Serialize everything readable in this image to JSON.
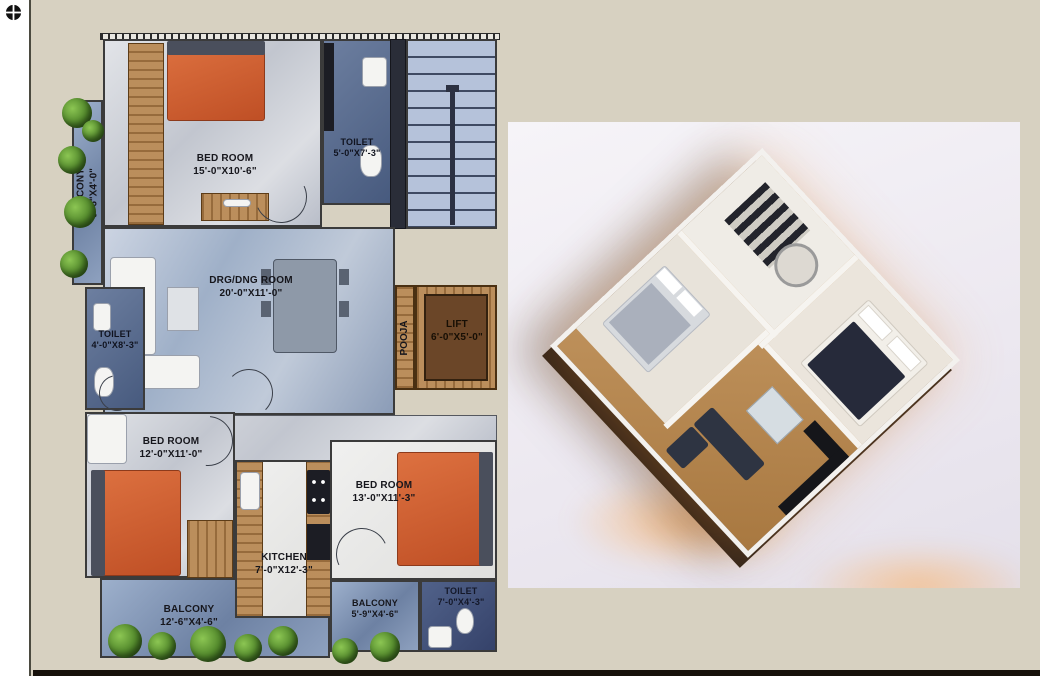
{
  "colors": {
    "page_bg": "#d7d1c1",
    "sidebar_bg": "#ffffff",
    "divider": "#4b4a40",
    "bottom_bar": "#17110b",
    "plan_text": "#16161c",
    "bed_orange": "#cd5f33",
    "floor_blue": "#7f93b4",
    "floor_grey": "#c9ccd3",
    "wood": "#b5854e",
    "photo_bg": "#efecf3"
  },
  "sidebar": {
    "icon": "crosshair-target-icon"
  },
  "plan2d": {
    "rooms": [
      {
        "label": "BED ROOM",
        "dims": "15'-0\"X10'-6\""
      },
      {
        "label": "TOILET",
        "dims": "5'-0\"X7'-3\""
      },
      {
        "label": "BALCONY",
        "dims": "9'-6\"X4'-0\""
      },
      {
        "label": "DRG/DNG ROOM",
        "dims": "20'-0\"X11'-0\""
      },
      {
        "label": "POOJA",
        "dims": ""
      },
      {
        "label": "LIFT",
        "dims": "6'-0\"X5'-0\""
      },
      {
        "label": "TOILET",
        "dims": "4'-0\"X8'-3\""
      },
      {
        "label": "BED ROOM",
        "dims": "12'-0\"X11'-0\""
      },
      {
        "label": "BED ROOM",
        "dims": "13'-0\"X11'-3\""
      },
      {
        "label": "KITCHEN",
        "dims": "7'-0\"X12'-3\""
      },
      {
        "label": "BALCONY",
        "dims": "12'-6\"X4'-6\""
      },
      {
        "label": "BALCONY",
        "dims": "5'-9\"X4'-6\""
      },
      {
        "label": "TOILET",
        "dims": "7'-0\"X4'-3\""
      }
    ]
  },
  "render3d": {
    "type": "isometric-3d-apartment-render"
  }
}
